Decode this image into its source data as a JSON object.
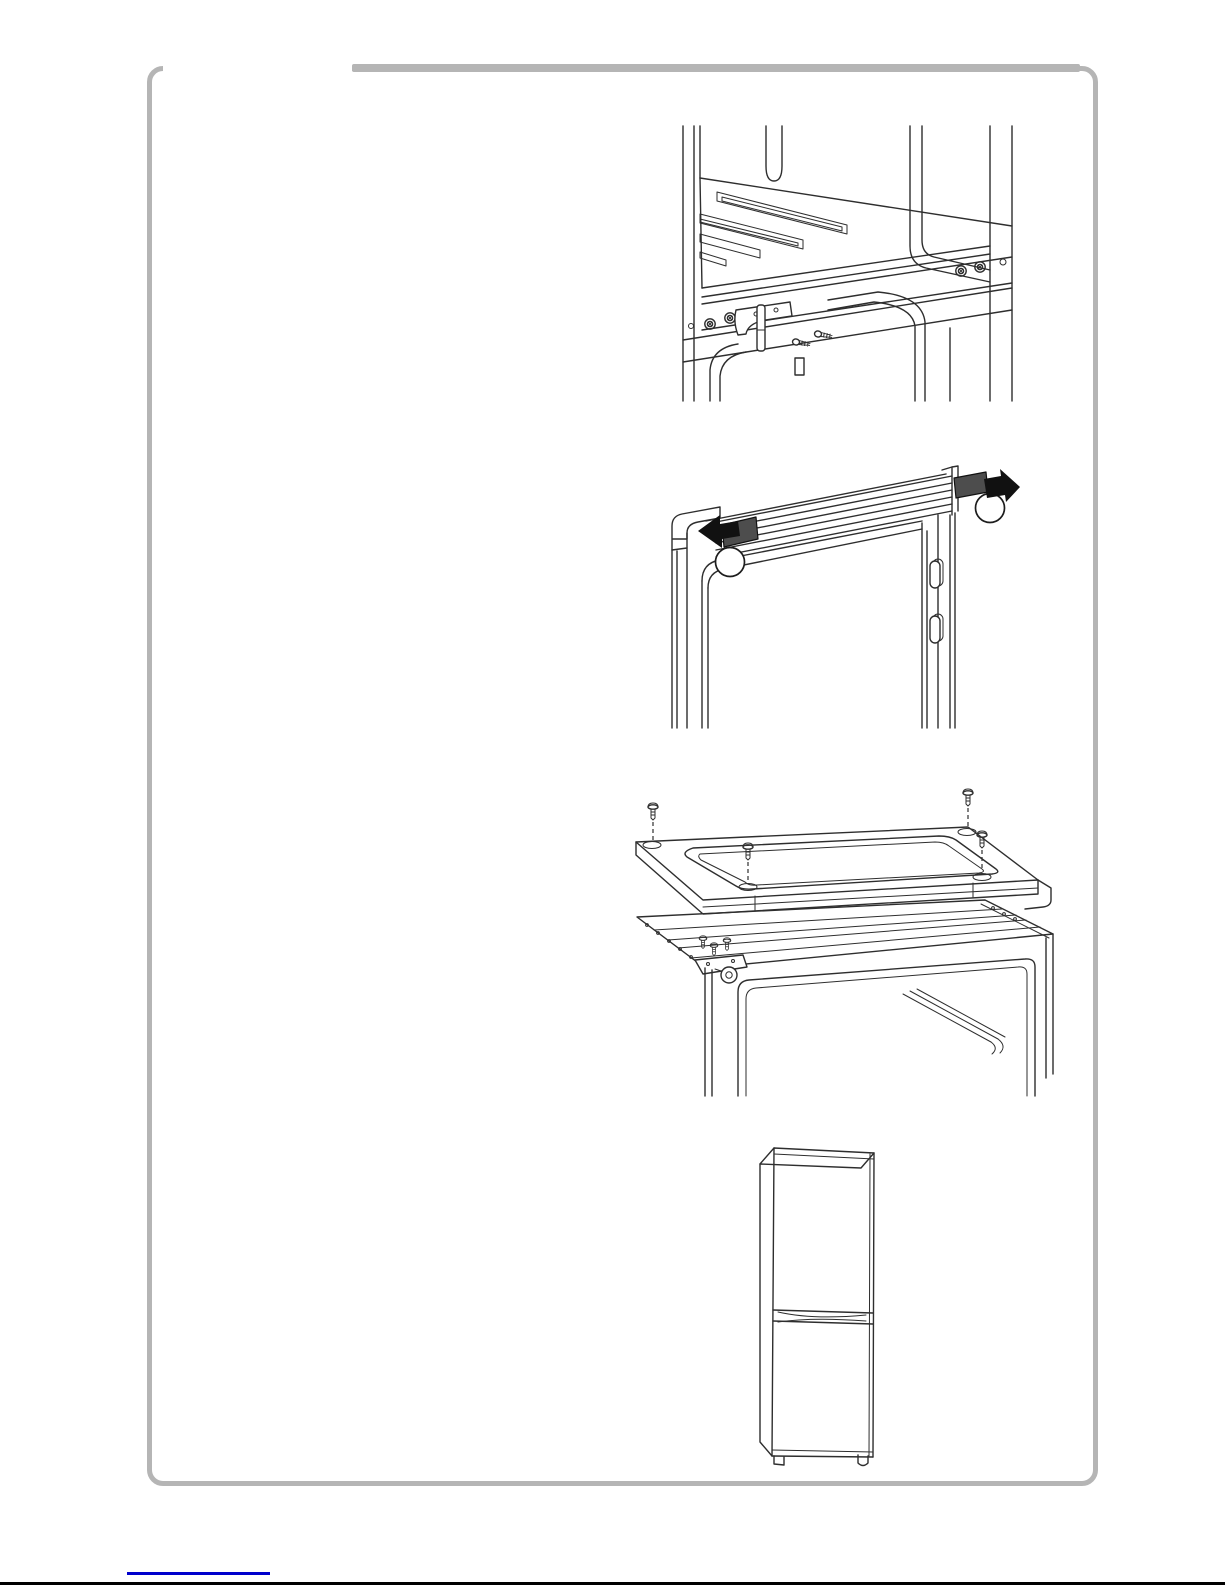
{
  "page": {
    "background": "#ffffff",
    "border_color": "#b5b5b5",
    "line_color": "#2e2e2e",
    "cap_fill": "#4d4d4d",
    "arrow_color": "#111111",
    "link_color": "#0000cc",
    "bottom_rule_color": "#000000"
  },
  "figures": [
    {
      "label": "fridge-interior-lower-hinge-bracket-and-screws-diagram"
    },
    {
      "label": "door-top-rail-hole-caps-with-removal-arrows-diagram"
    },
    {
      "label": "top-cover-mounting-screws-over-cabinet-diagram"
    },
    {
      "label": "assembled-fridge-freezer-diagram"
    }
  ],
  "footer": {
    "link_label": "document-link-underline"
  }
}
